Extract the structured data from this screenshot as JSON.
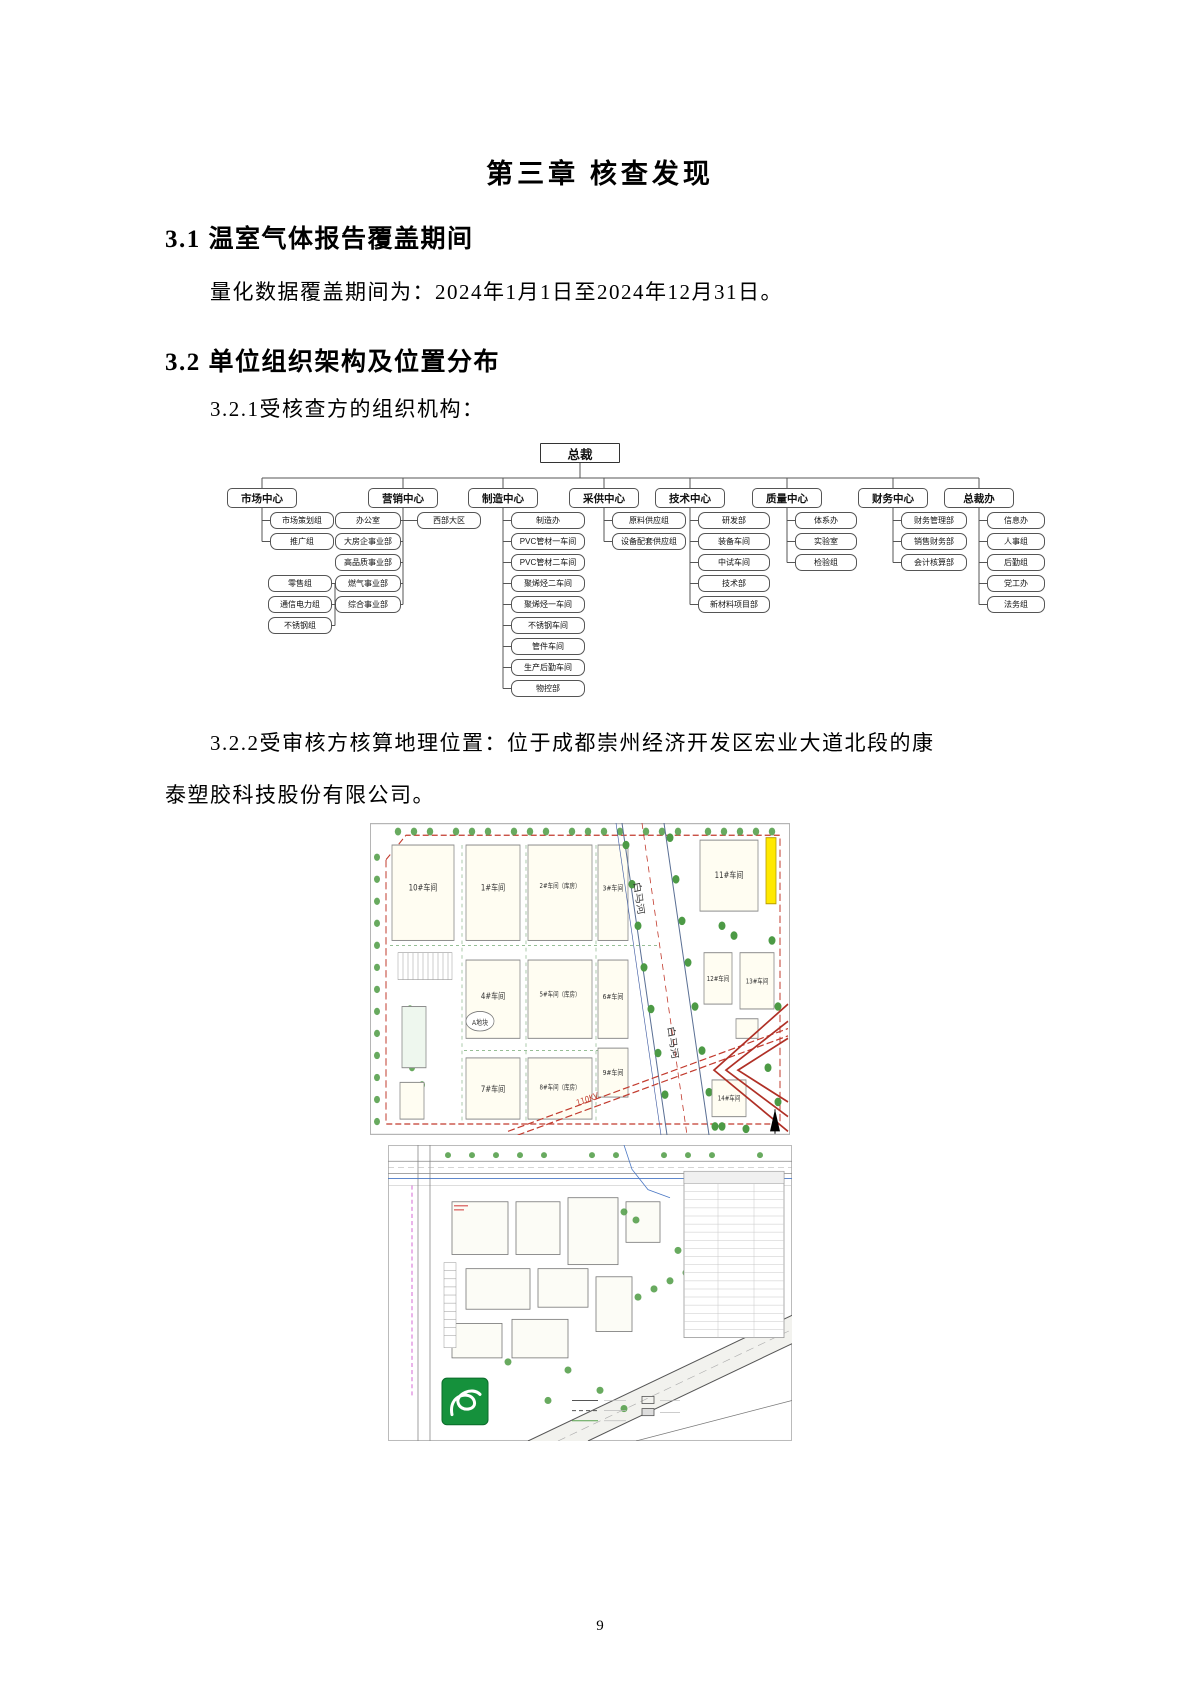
{
  "titles": {
    "chapter": "第三章 核查发现"
  },
  "sections": {
    "s31_heading": "3.1 温室气体报告覆盖期间",
    "s31_body": "量化数据覆盖期间为：2024年1月1日至2024年12月31日。",
    "s32_heading": "3.2 单位组织架构及位置分布",
    "s321": "3.2.1受核查方的组织机构：",
    "s322_line1": "3.2.2受审核方核算地理位置：位于成都崇州经济开发区宏业大道北段的康",
    "s322_line2": "泰塑胶科技股份有限公司。"
  },
  "org_chart": {
    "root": "总裁",
    "columns": [
      {
        "name": "市场中心",
        "children": [
          "市场策划组",
          "推广组"
        ]
      },
      {
        "name": "营销中心",
        "children": [
          "办公室",
          "大房企事业部",
          "高品质事业部",
          "燃气事业部",
          "综合事业部"
        ],
        "side_child": "西部大区"
      },
      {
        "name": "制造中心",
        "children": [
          "制造办",
          "PVC管材一车间",
          "PVC管材二车间",
          "聚烯烃二车间",
          "聚烯烃一车间",
          "不锈钢车间",
          "管件车间",
          "生产后勤车间",
          "物控部"
        ]
      },
      {
        "name": "采供中心",
        "children": [
          "原料供应组",
          "设备配套供应组"
        ]
      },
      {
        "name": "技术中心",
        "children": [
          "研发部",
          "装备车间",
          "中试车间",
          "技术部",
          "新材料项目部"
        ]
      },
      {
        "name": "质量中心",
        "children": [
          "体系办",
          "实验室",
          "检验组"
        ]
      },
      {
        "name": "财务中心",
        "children": [
          "财务管理部",
          "销售财务部",
          "会计核算部"
        ]
      },
      {
        "name": "总裁办",
        "children": [
          "信息办",
          "人事组",
          "后勤组",
          "党工办",
          "法务组"
        ]
      }
    ],
    "detached_group": [
      "零售组",
      "通信电力组",
      "不锈钢组"
    ]
  },
  "maps": {
    "map1": {
      "b10": "10#车间",
      "b1": "1#车间",
      "b2": "2#车间（库房）",
      "b3": "3#车间",
      "b4": "4#车间",
      "b5": "5#车间（库房）",
      "b6": "6#车间",
      "b7": "7#车间",
      "b8": "8#车间（库房）",
      "b9": "9#车间",
      "b11": "11#车间",
      "b12": "12#车间",
      "b13": "13#车间",
      "b14": "14#车间",
      "plotA": "A地块",
      "river": "白马河",
      "powerline": "110KV"
    }
  },
  "footer": {
    "page_number": "9"
  }
}
